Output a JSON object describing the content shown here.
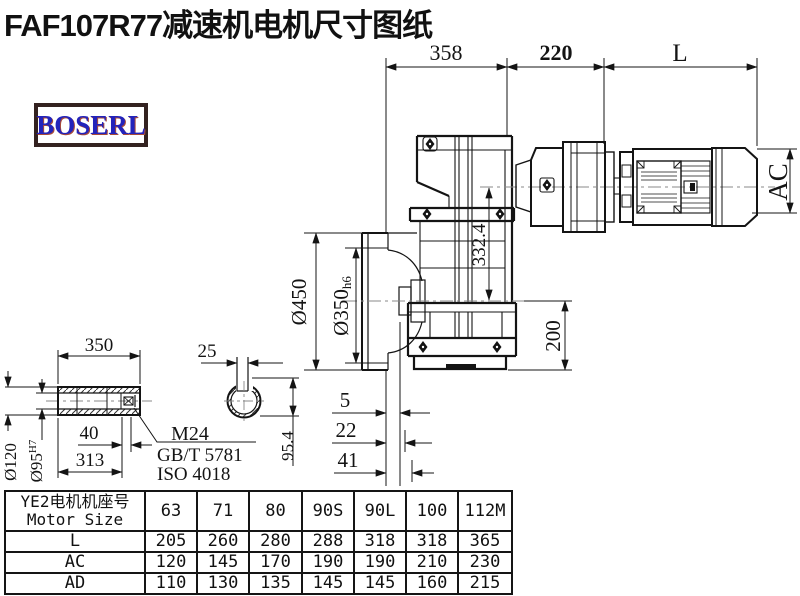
{
  "title": "FAF107R77减速机电机尺寸图纸",
  "logo": "BOSERL",
  "dims": {
    "width_358": "358",
    "width_220": "220",
    "motor_length": "L",
    "motor_height": "AC",
    "flange_od": "Ø450",
    "spigot_d": "Ø350",
    "spigot_tol": "h6",
    "axis_offset": "332.4",
    "base_height": "200",
    "face_5": "5",
    "face_22": "22",
    "face_41": "41"
  },
  "shaft": {
    "length_350": "350",
    "key_25": "25",
    "od": "Ø120",
    "bore": "Ø95",
    "bore_tol": "H7",
    "end_40": "40",
    "len_313": "313",
    "key_height": "95.4",
    "screw": "M24",
    "std_gb": "GB/T 5781",
    "std_iso": "ISO 4018"
  },
  "table": {
    "header_cn": "YE2电机机座号",
    "header_en": "Motor Size",
    "columns": [
      "63",
      "71",
      "80",
      "90S",
      "90L",
      "100",
      "112M"
    ],
    "rows": [
      {
        "label": "L",
        "values": [
          "205",
          "260",
          "280",
          "288",
          "318",
          "318",
          "365"
        ]
      },
      {
        "label": "AC",
        "values": [
          "120",
          "145",
          "170",
          "190",
          "190",
          "210",
          "230"
        ]
      },
      {
        "label": "AD",
        "values": [
          "110",
          "130",
          "135",
          "145",
          "145",
          "160",
          "215"
        ]
      }
    ]
  },
  "colors": {
    "line": "#141414",
    "logo_blue": "#2323bb",
    "logo_border": "#332220"
  }
}
